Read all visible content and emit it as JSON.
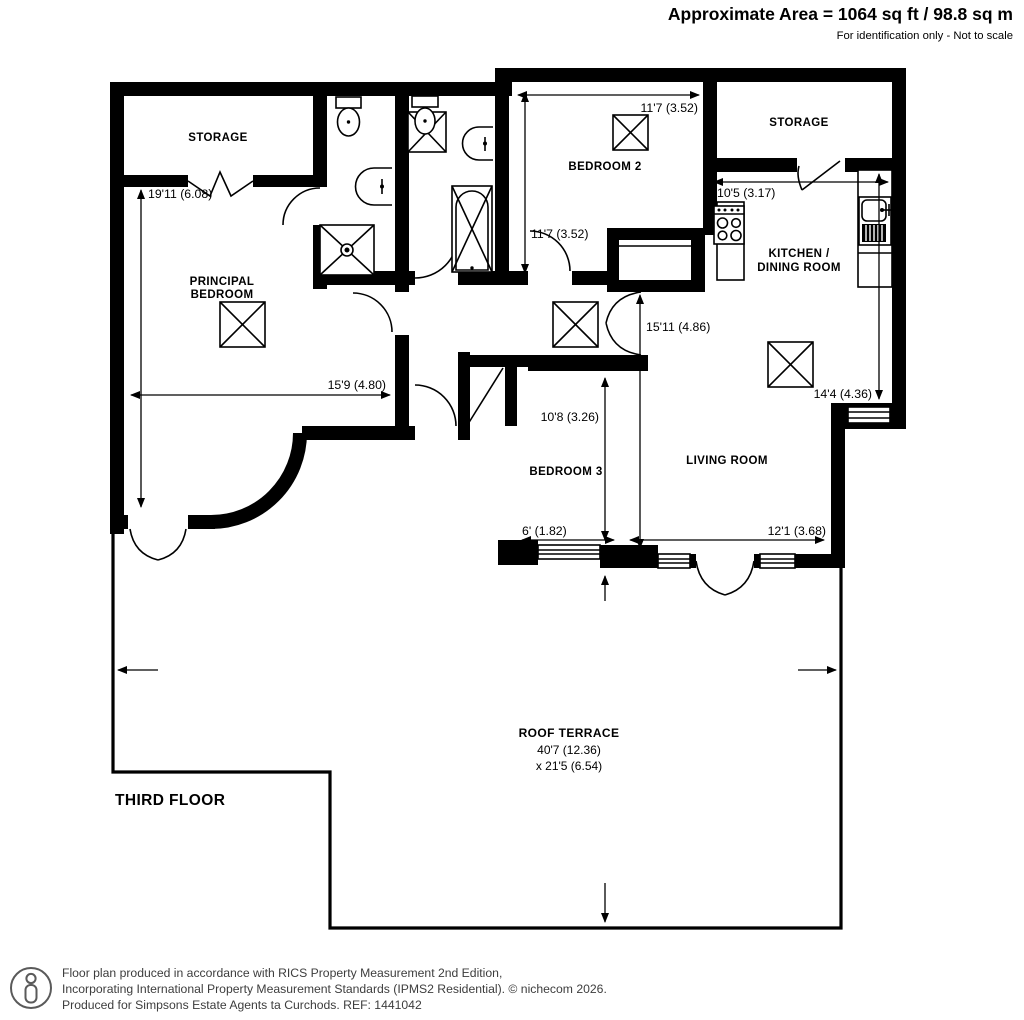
{
  "header": {
    "area": "Approximate Area = 1064 sq ft / 98.8 sq m",
    "note": "For identification only - Not to scale"
  },
  "floor_label": "THIRD FLOOR",
  "rooms": {
    "storage_left": {
      "name": "STORAGE"
    },
    "principal": {
      "line1": "PRINCIPAL",
      "line2": "BEDROOM"
    },
    "bedroom2": {
      "name": "BEDROOM 2"
    },
    "storage_right": {
      "name": "STORAGE"
    },
    "kitchen": {
      "line1": "KITCHEN /",
      "line2": "DINING ROOM"
    },
    "living": {
      "name": "LIVING ROOM"
    },
    "bedroom3": {
      "name": "BEDROOM 3"
    },
    "terrace": {
      "name": "ROOF TERRACE",
      "dim_w": "40'7 (12.36)",
      "dim_d": "x 21'5 (6.54)"
    }
  },
  "dims": {
    "principal_v": "19'11 (6.08)",
    "principal_h": "15'9 (4.80)",
    "bed2_h": "11'7 (3.52)",
    "bed2_v": "11'7 (3.52)",
    "kitchen_w": "10'5 (3.17)",
    "kitchen_d": "14'4 (4.36)",
    "hall_v": "15'11 (4.86)",
    "bed3_v": "10'8 (3.26)",
    "bed3_w": "6' (1.82)",
    "living_w": "12'1 (3.68)"
  },
  "footer": {
    "line1": "Floor plan produced in accordance with RICS Property Measurement 2nd Edition,",
    "line2": "Incorporating International Property Measurement Standards (IPMS2 Residential).   © nichecom 2026.",
    "line3": "Produced for Simpsons Estate Agents ta Curchods.   REF: 1441042"
  },
  "colors": {
    "wall": "#000000",
    "footer_text": "#3d3d3d"
  }
}
